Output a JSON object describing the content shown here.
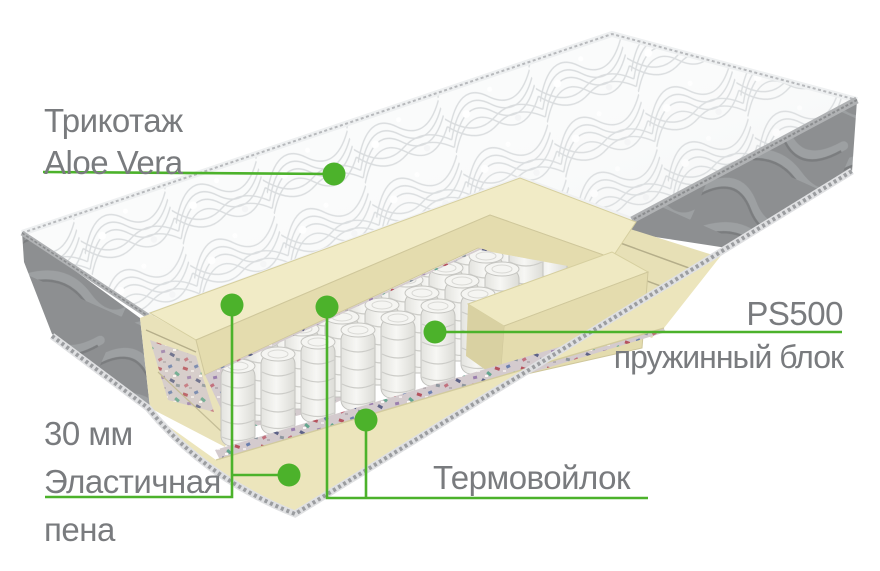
{
  "colors": {
    "accent_green": "#4cb22b",
    "label_gray": "#797b7e",
    "foam_cream": "#efe8c0",
    "panel_gray": "#8d8f91",
    "quilt_white": "#fafbfb"
  },
  "labels": {
    "fabric": {
      "line1": "Трикотаж",
      "line2": "Aloe Vera"
    },
    "foam": {
      "line1": "30 мм",
      "line2": "Эластичная",
      "line3": "пена"
    },
    "felt": {
      "line1": "Термовойлок"
    },
    "springs": {
      "line1": "PS500",
      "line2": "пружинный блок"
    }
  }
}
